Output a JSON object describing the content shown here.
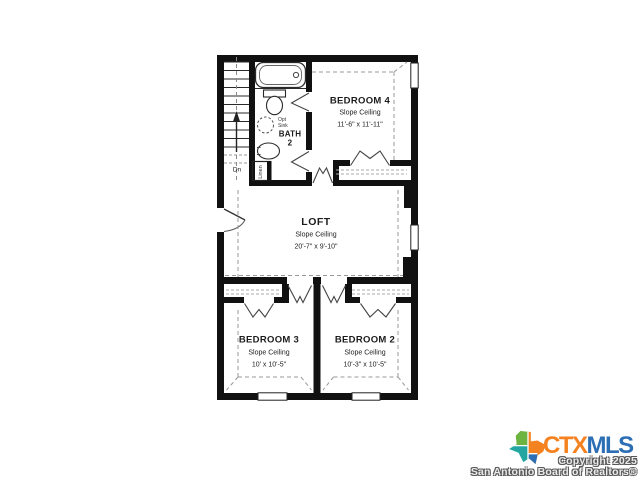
{
  "plan": {
    "rooms": {
      "bedroom4": {
        "name": "BEDROOM 4",
        "ceiling": "Slope Ceiling",
        "dims": "11'-6\" x 11'-11\""
      },
      "loft": {
        "name": "LOFT",
        "ceiling": "Slope Ceiling",
        "dims": "20'-7\" x 9'-10\""
      },
      "bedroom3": {
        "name": "BEDROOM 3",
        "ceiling": "Slope Ceiling",
        "dims": "10' x 10'-5\""
      },
      "bedroom2": {
        "name": "BEDROOM 2",
        "ceiling": "Slope Ceiling",
        "dims": "10'-3\" x 10'-5\""
      },
      "bath": {
        "name": "BATH",
        "number": "2"
      },
      "linen": {
        "label": "Linen"
      },
      "stairs": {
        "label": "Dn"
      },
      "opt_sink": {
        "line1": "Opt",
        "line2": "Sink"
      }
    },
    "colors": {
      "wall": "#111111",
      "background": "#ffffff",
      "dashed_ceiling": "#999999"
    }
  },
  "branding": {
    "logo": {
      "ctx": "CTX",
      "mls": "MLS",
      "ctx_color": "#F58220",
      "mls_color": "#2D6FB5",
      "texas_green": "#6CB33F",
      "texas_orange": "#F58220",
      "texas_teal": "#23A6A1",
      "texas_blue": "#2D6FB5"
    },
    "copyright_line1": "Copyright 2025",
    "copyright_line2": "San Antonio Board of Realtors®"
  }
}
